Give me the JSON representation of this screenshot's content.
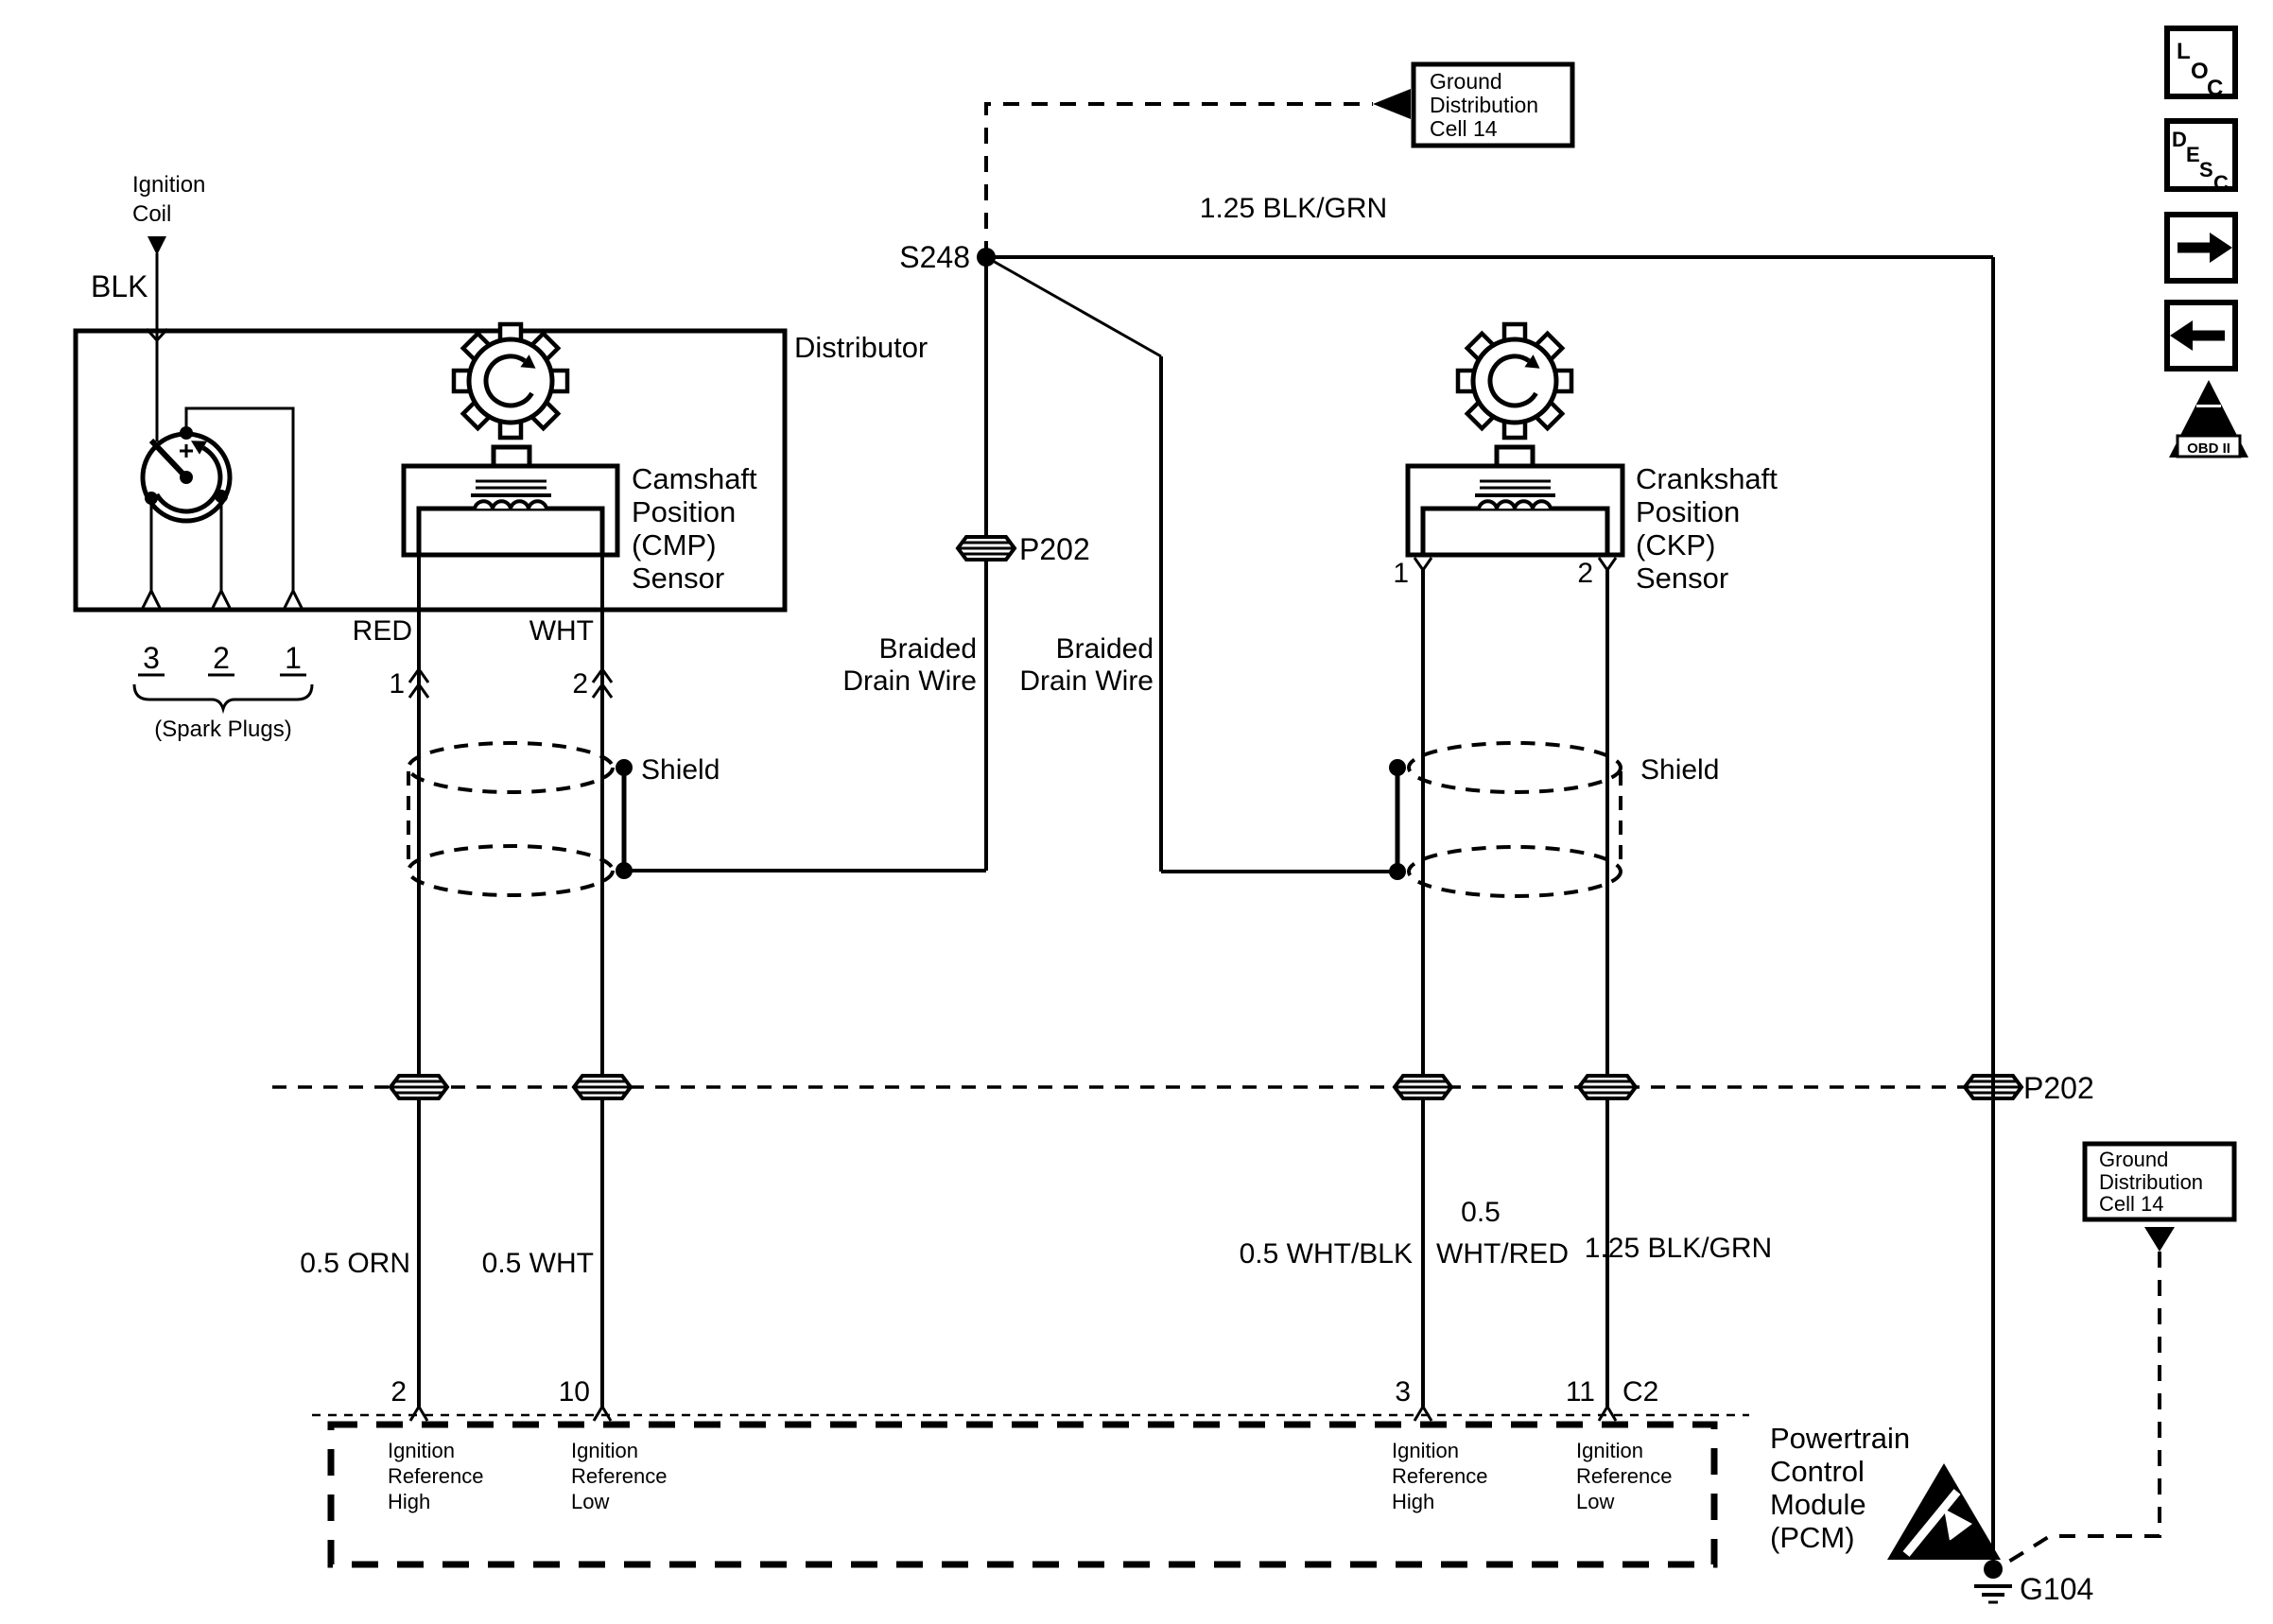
{
  "nav": {
    "loc_letters": [
      "L",
      "O",
      "C"
    ],
    "desc_letters": [
      "D",
      "E",
      "S",
      "C"
    ],
    "obd": {
      "numeral": "II",
      "label": "OBD II"
    }
  },
  "ignition_coil": {
    "l1": "Ignition",
    "l2": "Coil",
    "wire_color": "BLK"
  },
  "distributor": {
    "label": "Distributor",
    "spark_pins": [
      "3",
      "2",
      "1"
    ],
    "spark_note": "(Spark Plugs)"
  },
  "cmp": {
    "l1": "Camshaft",
    "l2": "Position",
    "l3": "(CMP)",
    "l4": "Sensor",
    "wire1_color": "RED",
    "wire2_color": "WHT",
    "pin1": "1",
    "pin2": "2"
  },
  "ckp": {
    "l1": "Crankshaft",
    "l2": "Position",
    "l3": "(CKP)",
    "l4": "Sensor",
    "pin1": "1",
    "pin2": "2"
  },
  "junctions": {
    "s248": "S248",
    "g104": "G104"
  },
  "connectors": {
    "p202_inline": "P202",
    "p202_line": "P202"
  },
  "shields": {
    "label": "Shield",
    "braided_l1": "Braided",
    "braided_l2": "Drain Wire"
  },
  "wires": {
    "blkgrn_top": "1.25 BLK/GRN",
    "orn": "0.5 ORN",
    "wht": "0.5 WHT",
    "whtblk": "0.5 WHT/BLK",
    "whtred_l1": "0.5",
    "whtred_l2": "WHT/RED",
    "blkgrn_bottom": "1.25 BLK/GRN"
  },
  "ground_cell": {
    "l1": "Ground",
    "l2": "Distribution",
    "l3": "Cell 14"
  },
  "pcm": {
    "l1": "Powertrain",
    "l2": "Control",
    "l3": "Module",
    "l4": "(PCM)",
    "pin2": "2",
    "pin10": "10",
    "pin3": "3",
    "pin11": "11",
    "conn": "C2",
    "ref_high": {
      "l1": "Ignition",
      "l2": "Reference",
      "l3": "High"
    },
    "ref_low": {
      "l1": "Ignition",
      "l2": "Reference",
      "l3": "Low"
    }
  }
}
